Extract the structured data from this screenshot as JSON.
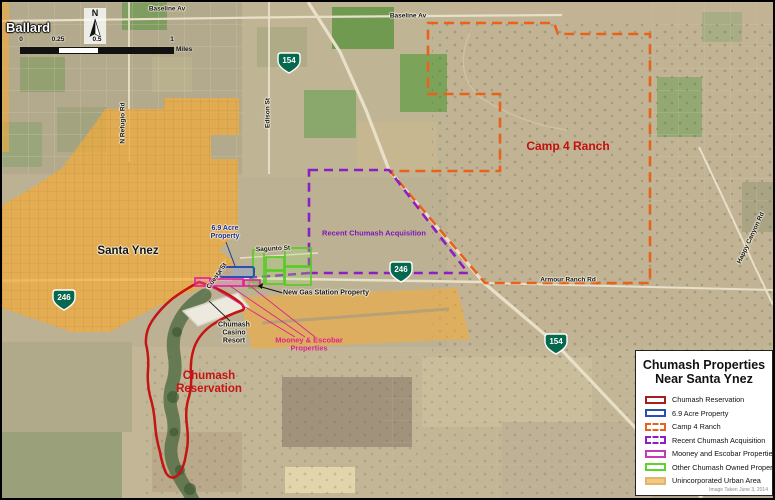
{
  "legend": {
    "title_line1": "Chumash Properties",
    "title_line2": "Near Santa Ynez",
    "items": [
      {
        "label": "Chumash Reservation",
        "color": "#a81e1e",
        "border": "solid",
        "fill": "#ffffff"
      },
      {
        "label": "6.9 Acre Property",
        "color": "#2a4fae",
        "border": "solid",
        "fill": "#ffffff"
      },
      {
        "label": "Camp 4 Ranch",
        "color": "#e8621d",
        "border": "dashed",
        "fill": "#ffffff"
      },
      {
        "label": "Recent Chumash Acquisition",
        "color": "#8b1fc4",
        "border": "dashed",
        "fill": "#ffffff"
      },
      {
        "label": "Mooney and Escobar Properties",
        "color": "#c23ab5",
        "border": "solid",
        "fill": "#ffffff"
      },
      {
        "label": "Other Chumash Owned Property",
        "color": "#5fd32a",
        "border": "solid",
        "fill": "#ffffff"
      },
      {
        "label": "Unincorporated Urban Area",
        "color": "#dcb674",
        "border": "solid",
        "fill": "#f7c97e"
      }
    ],
    "credit": "Image Taken June 3, 2014"
  },
  "scale_bar": {
    "tick0": "0",
    "tick1": "0.25",
    "tick2": "0.5",
    "tick3": "1",
    "unit": "Miles"
  },
  "compass": {
    "label": "N"
  },
  "map": {
    "towns": {
      "ballard": "Ballard",
      "santa_ynez": "Santa Ynez"
    },
    "areas": {
      "camp4": "Camp 4 Ranch",
      "acquisition": "Recent Chumash Acquisition",
      "reservation": "Chumash Reservation",
      "mooney": "Mooney & Escobar Properties",
      "casino": "Chumash Casino Resort",
      "gas_station": "New Gas Station Property",
      "acre": "6.9 Acre Property"
    },
    "roads": {
      "baseline_av": "Baseline Av",
      "edison_st": "Edison St",
      "n_refugio_rd": "N Refugio Rd",
      "sagunto_st": "Sagunto St",
      "cuesta_st": "Cuesta St",
      "armour_ranch_rd": "Armour Ranch Rd",
      "happy_canyon_rd": "Happy Canyon Rd"
    },
    "shields": {
      "hwy154": "154",
      "hwy246": "246"
    }
  }
}
